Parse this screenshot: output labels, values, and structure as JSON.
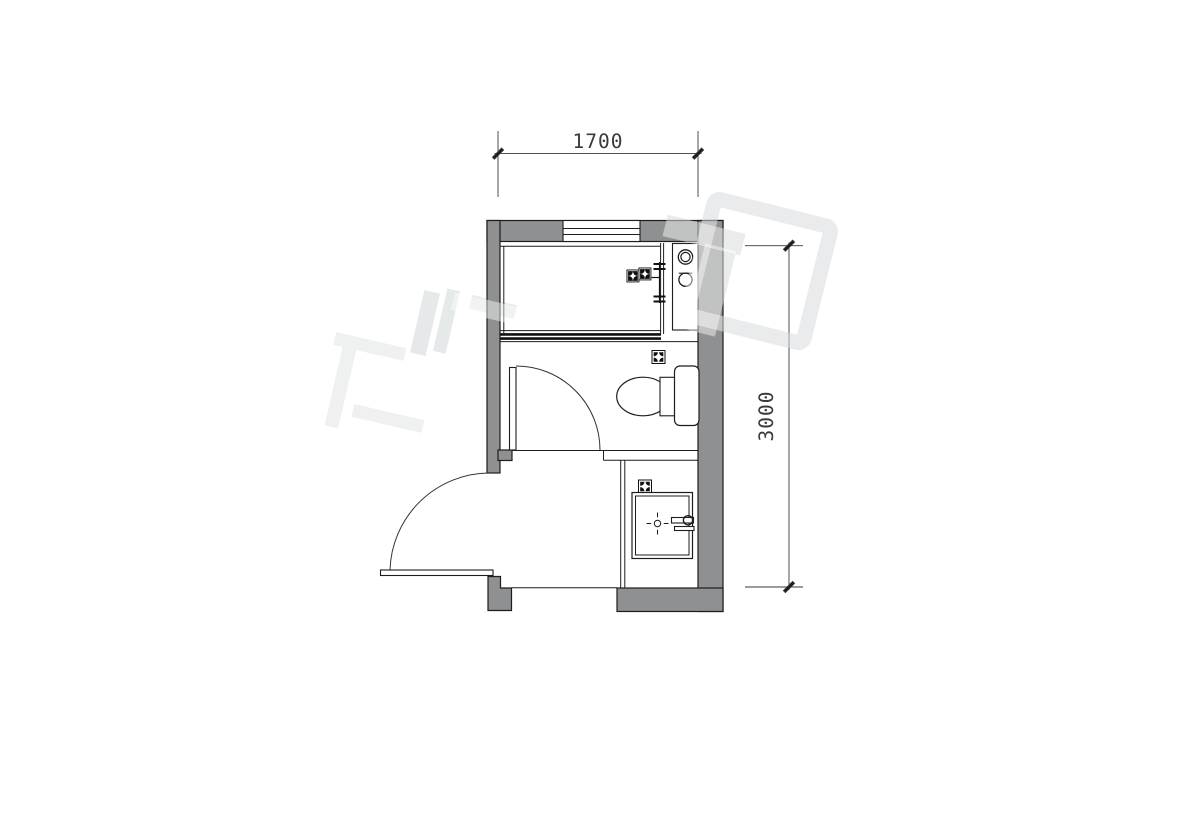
{
  "drawing": {
    "type": "architectural-floor-plan",
    "room": "bathroom",
    "dimensions": {
      "width": "1700",
      "height": "3000"
    },
    "fixtures": [
      "window",
      "shower-area",
      "shower-glass-partition",
      "shower-mixer",
      "countertop-with-basins",
      "toilet",
      "floor-drain",
      "interior-door",
      "entry-door",
      "vanity-counter",
      "washbasin",
      "faucet"
    ],
    "colors": {
      "background": "#ffffff",
      "wall_fill": "#8e9091",
      "line": "#1d1d1d",
      "dimension": "#3a3a3a",
      "watermark": "#d7dbdc"
    }
  }
}
